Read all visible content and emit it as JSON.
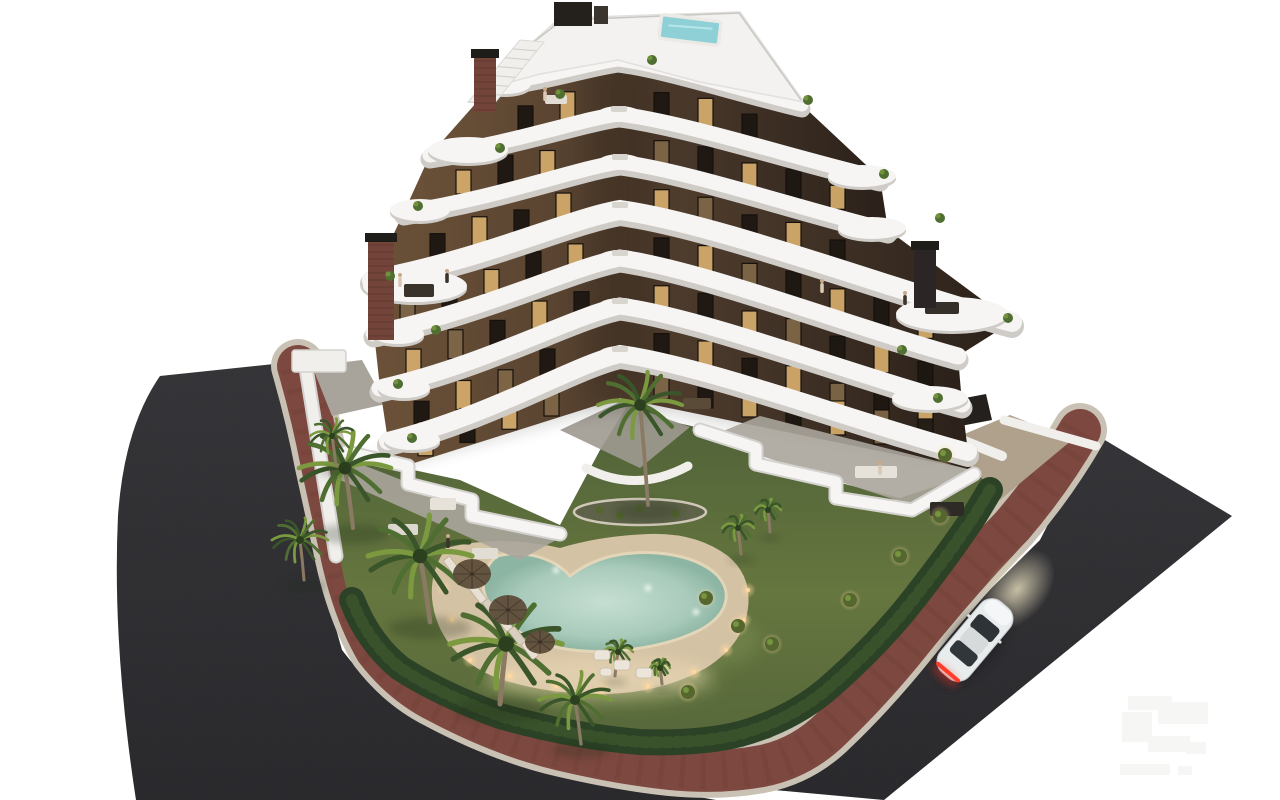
{
  "meta": {
    "title": "Dusk aerial 3D render of a modern apartment building with curved white balconies, dark brown facade, landscaped garden, heart-shaped pool, palm trees, perimeter bike path and roads with a white sports car",
    "canvas_width": 1280,
    "canvas_height": 800
  },
  "colors": {
    "background": "#ffffff",
    "asphalt": "#3e3e42",
    "asphalt_dark": "#313135",
    "curb": "#c9c2b4",
    "bike_path": "#7d483f",
    "bike_path_texture": "#6b3b33",
    "lawn_top": "#4e6138",
    "lawn_mid": "#66763f",
    "lawn_low": "#55663a",
    "lawn_light": "#7f9055",
    "hedge": "#2c4226",
    "hedge_light": "#3e5a2e",
    "wall_white": "#f0efec",
    "wall_shadow": "#d4d2ce",
    "paving": "#a8a49b",
    "paving_tan": "#b0a18c",
    "deck": "#d4c2a4",
    "deck_light": "#ead9b6",
    "pool_center": "#c6dfd2",
    "pool_deep": "#8db5a3",
    "pool_rim": "#e3d6b8",
    "band_white": "#f6f5f3",
    "band_shadow": "#cfccc7",
    "facade_light": "#6b5138",
    "facade_mid": "#4a392b",
    "facade_dark": "#2b211a",
    "window_dark": "#1d1712",
    "window_lit": "#d2a96a",
    "window_dim": "#7e6647",
    "brick": "#73453a",
    "brick_line": "#57332c",
    "chimney_dark": "#2b2625",
    "cap_dark": "#1f1d1a",
    "palm_dark": "#3a5529",
    "palm_mid": "#4f6e31",
    "palm_light": "#7b9a40",
    "trunk": "#8b7a63",
    "shrub": "#55662f",
    "glow_warm": "#ffd9a0",
    "car_body": "#e9eced",
    "car_roof": "#d6dadb",
    "car_glass": "#2d3337",
    "tail_red": "#ff3b2a",
    "headlight": "#f8eecb",
    "roof_pool": "#8ed0d6",
    "watermark": "#f6f6f4"
  },
  "roads": {
    "asphalt_left_d": "M 160,376 L 274,364 L 298,466 L 316,558 L 342,650 Q 382,702 424,720 Q 512,758 612,782 L 716,800 L 884,800 L 136,800 Q 112,644 118,516 Q 124,428 160,376 Z",
    "asphalt_right_d": "M 800,778 L 1040,540 L 1088,446 L 1078,424 L 1232,516 L 884,800 L 752,788 Z",
    "path_d": "M 298,366 Q 312,414 322,466 Q 334,520 342,558 Q 354,612 376,650 Q 402,684 438,702 Q 502,736 562,750 Q 622,764 670,769 Q 720,774 762,766 Q 802,758 832,728 Q 872,690 912,640 Q 962,578 1012,526 Q 1050,482 1080,430",
    "curb_width": 54,
    "path_width": 42
  },
  "garden": {
    "lawn_d": "M 330,452 L 460,480 L 560,525 L 600,450 L 632,398 L 665,420 L 700,428 L 790,470 L 900,498 L 985,470 L 975,520 Q 940,575 890,635 Q 840,700 770,738 Q 700,758 620,752 Q 520,736 440,700 Q 390,672 366,640 Q 346,600 340,556 Z",
    "hedge_d": "M 352,600 Q 368,642 400,668 Q 440,694 500,716 Q 570,736 640,742 Q 700,744 740,734 Q 790,720 826,690 Q 870,652 905,610 Q 945,560 975,515 L 990,490",
    "wall_d": "M 306,368 L 336,556",
    "paving_left_d": "M 312,366 L 362,360 L 386,404 L 332,416 Z",
    "paving_right_d": "M 950,440 L 1010,415 L 1072,440 L 1000,500 Z",
    "wall_right1_d": "M 938,360 L 942,432",
    "wall_right2_d": "M 942,432 L 1002,456",
    "wall_far_d": "M 1004,420 L 1096,446",
    "garage_d": "M 944,402 L 986,394 L 992,420 L 950,428 Z",
    "pergola": {
      "x": 292,
      "y": 350,
      "w": 54,
      "h": 22
    },
    "bed": {
      "cx": 640,
      "cy": 512,
      "rx": 66,
      "ry": 13
    },
    "planter_d": "M 586,468 Q 636,494 688,466",
    "courtyard_d": "M 560,430 L 620,402 L 690,427 L 640,468 Z"
  },
  "pool": {
    "deck_d": "M 446,548 Q 424,580 436,618 Q 448,656 492,676 Q 540,694 600,694 Q 660,694 706,668 Q 744,644 748,608 Q 752,576 728,556 Q 696,532 648,534 Q 600,536 560,548 Q 500,534 446,548 Z",
    "water_d": "M 497,556 C 478,572 478,596 500,618 C 515,632 540,644 560,648 C 600,656 660,650 700,630 C 728,615 734,592 716,574 C 694,554 650,548 612,556 C 595,560 580,568 570,576 C 558,562 530,548 497,556 Z",
    "deck_lights": [
      [
        470,
        660
      ],
      [
        510,
        676
      ],
      [
        556,
        686
      ],
      [
        602,
        690
      ],
      [
        648,
        686
      ],
      [
        694,
        672
      ],
      [
        726,
        650
      ],
      [
        744,
        620
      ],
      [
        748,
        590
      ],
      [
        452,
        620
      ],
      [
        444,
        588
      ]
    ],
    "pool_lights": [
      [
        556,
        570
      ],
      [
        648,
        588
      ],
      [
        696,
        612
      ]
    ],
    "lit_patches": [
      [
        600,
        682,
        120,
        26
      ],
      [
        700,
        640,
        60,
        30
      ],
      [
        470,
        600,
        40,
        40
      ]
    ]
  },
  "amenities": {
    "loungers": {
      "x": 452,
      "y": 566,
      "dx": 13,
      "dy": 14,
      "count": 7,
      "angle": -38,
      "w": 8,
      "h": 19
    },
    "umbrellas": [
      [
        472,
        574,
        19
      ],
      [
        508,
        610,
        19
      ],
      [
        540,
        642,
        15
      ]
    ],
    "sofas": [
      [
        594,
        650,
        16,
        10
      ],
      [
        614,
        660,
        16,
        10
      ],
      [
        636,
        668,
        16,
        10
      ],
      [
        600,
        668,
        12,
        8
      ]
    ],
    "people": [
      [
        400,
        282
      ],
      [
        447,
        278
      ],
      [
        545,
        96
      ],
      [
        905,
        300
      ],
      [
        880,
        470
      ],
      [
        448,
        543
      ],
      [
        822,
        288
      ]
    ]
  },
  "vegetation": {
    "palms_large": [
      [
        345,
        468,
        46,
        8,
        60
      ],
      [
        420,
        556,
        52,
        10,
        66
      ],
      [
        506,
        644,
        56,
        -6,
        60
      ],
      [
        575,
        700,
        36,
        6,
        44
      ],
      [
        300,
        540,
        28,
        4,
        40
      ],
      [
        332,
        436,
        22,
        4,
        30
      ],
      [
        640,
        405,
        42,
        8,
        100
      ]
    ],
    "palms_small": [
      [
        738,
        528,
        16,
        3,
        26
      ],
      [
        768,
        510,
        13,
        2,
        22
      ],
      [
        618,
        652,
        15,
        -3,
        24
      ],
      [
        660,
        668,
        10,
        2,
        16
      ]
    ],
    "shrubs": [
      [
        706,
        598
      ],
      [
        738,
        626
      ],
      [
        772,
        644
      ],
      [
        850,
        600
      ],
      [
        900,
        556
      ],
      [
        940,
        516
      ],
      [
        688,
        692
      ],
      [
        945,
        455
      ]
    ]
  },
  "building": {
    "bands": [
      [
        [
          528,
          48
        ],
        [
          618,
          30
        ],
        [
          758,
          56
        ]
      ],
      [
        [
          492,
          85
        ],
        [
          618,
          60
        ],
        [
          802,
          105
        ]
      ],
      [
        [
          430,
          155
        ],
        [
          619,
          114
        ],
        [
          880,
          178
        ]
      ],
      [
        [
          404,
          212
        ],
        [
          620,
          162
        ],
        [
          888,
          230
        ]
      ],
      [
        [
          372,
          280
        ],
        [
          620,
          210
        ],
        [
          1012,
          322
        ]
      ],
      [
        [
          374,
          333
        ],
        [
          620,
          258
        ],
        [
          958,
          356
        ]
      ],
      [
        [
          380,
          388
        ],
        [
          620,
          306
        ],
        [
          962,
          404
        ]
      ],
      [
        [
          388,
          441
        ],
        [
          620,
          354
        ],
        [
          968,
          452
        ]
      ],
      [
        [
          392,
          470
        ],
        [
          620,
          398
        ],
        [
          972,
          470
        ]
      ]
    ],
    "band_widths": [
      13,
      15,
      15,
      20,
      17,
      17,
      18
    ],
    "terrace_ellipses": [
      [
        505,
        84,
        26,
        10
      ],
      [
        468,
        150,
        40,
        13
      ],
      [
        420,
        210,
        30,
        11
      ],
      [
        415,
        286,
        52,
        16
      ],
      [
        952,
        314,
        56,
        17
      ],
      [
        930,
        398,
        38,
        12
      ],
      [
        398,
        334,
        26,
        10
      ],
      [
        404,
        388,
        26,
        10
      ],
      [
        412,
        440,
        28,
        10
      ],
      [
        862,
        176,
        34,
        11
      ],
      [
        872,
        228,
        34,
        11
      ]
    ],
    "furniture": [
      [
        404,
        284,
        30,
        13,
        "#3a332b"
      ],
      [
        545,
        95,
        22,
        9,
        "#e2ddd4"
      ],
      [
        925,
        302,
        34,
        12,
        "#35302a"
      ],
      [
        855,
        466,
        42,
        12,
        "#e6e2da"
      ],
      [
        930,
        502,
        34,
        14,
        "#2e2a26"
      ],
      [
        430,
        498,
        26,
        12,
        "#e6e2da"
      ],
      [
        388,
        524,
        30,
        11,
        "#ddd8cf"
      ],
      [
        472,
        548,
        26,
        11,
        "#e2ddd4"
      ],
      [
        683,
        398,
        28,
        11,
        "#5a4a38"
      ]
    ],
    "plants": [
      [
        500,
        148
      ],
      [
        418,
        206
      ],
      [
        390,
        276
      ],
      [
        436,
        330
      ],
      [
        398,
        384
      ],
      [
        940,
        218
      ],
      [
        884,
        174
      ],
      [
        902,
        350
      ],
      [
        938,
        398
      ],
      [
        808,
        100
      ],
      [
        652,
        60
      ],
      [
        560,
        94
      ],
      [
        1008,
        318
      ],
      [
        412,
        438
      ]
    ],
    "chimneys": [
      {
        "x": 474,
        "y": 56,
        "w": 22,
        "h": 56,
        "brick": true
      },
      {
        "x": 368,
        "y": 240,
        "w": 26,
        "h": 100,
        "brick": true
      },
      {
        "x": 914,
        "y": 248,
        "w": 22,
        "h": 60,
        "brick": false
      }
    ],
    "roof": {
      "deck_d": "M 496,86 L 528,46 L 560,18 L 740,12 L 804,102 L 700,82 L 618,60 L 540,74 Z",
      "rail_d": "M 500,84 L 531,44 L 562,20 L 739,13 L 801,100",
      "core": {
        "x": 554,
        "y": 2,
        "w": 38,
        "h": 24
      },
      "pool": {
        "x": 660,
        "y": 18,
        "w": 60,
        "h": 24,
        "angle": 7
      },
      "stairs_d": "M 468,102 L 520,40 L 544,42 L 494,104 Z"
    },
    "ground_walls": [
      "M 346,452 L 408,466 L 408,484 L 472,500 L 472,516 L 540,530 L 560,534",
      "M 700,430 L 756,448 L 756,464 L 836,482 L 836,498 L 912,510 L 974,474"
    ],
    "ground_floors": [
      "M 350,460 L 556,540 L 520,560 L 340,480 Z",
      "M 706,438 L 908,504 L 972,470 L 760,416 Z"
    ]
  },
  "car": {
    "x": 975,
    "y": 640,
    "angle": 40
  },
  "watermark": {
    "rects": [
      [
        1128,
        696,
        44,
        14
      ],
      [
        1122,
        712,
        30,
        30
      ],
      [
        1158,
        702,
        50,
        22
      ],
      [
        1148,
        736,
        42,
        16
      ],
      [
        1186,
        742,
        20,
        12
      ],
      [
        1120,
        764,
        50,
        11
      ],
      [
        1178,
        766,
        14,
        9
      ]
    ]
  }
}
